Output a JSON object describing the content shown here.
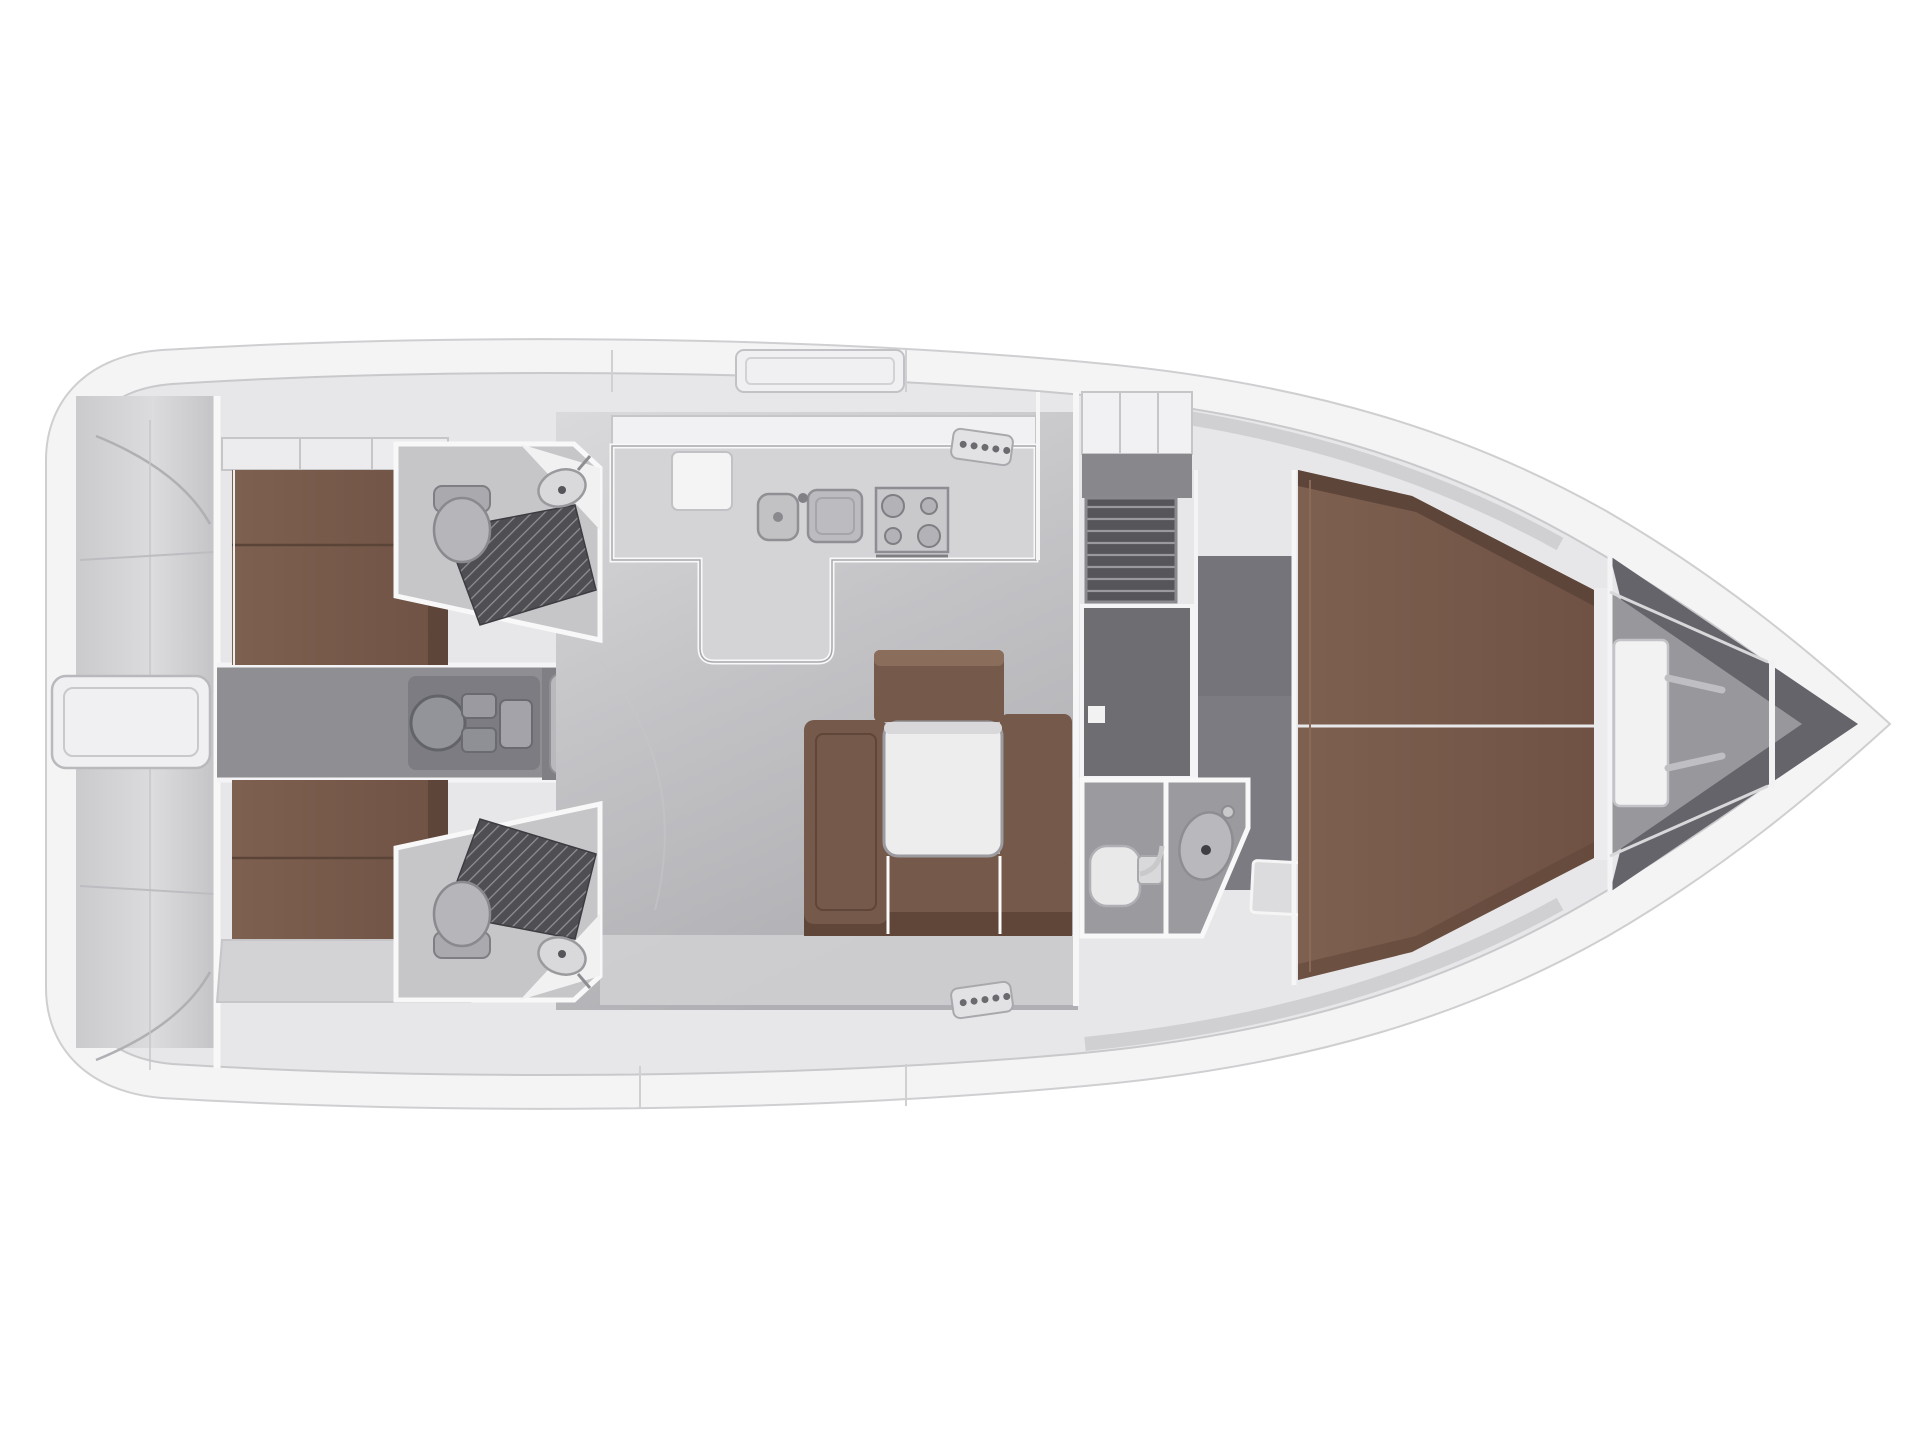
{
  "figure": {
    "kind": "sailing-yacht-interior-floor-plan-top-view",
    "orientation": "bow-right-stern-left"
  },
  "palette": {
    "background": "#ffffff",
    "hull_fill": "#f4f4f5",
    "hull_stroke": "#cfcfd2",
    "deck_fill": "#e7e7e9",
    "deck_line": "#c9c9cc",
    "cabinet_white": "#f1f1f3",
    "wall_white": "#f8f8f9",
    "counter_fill": "#d4d4d7",
    "floor_light": "#d8d8da",
    "floor_mid": "#b9b9bd",
    "corridor_floor": "#8e8e93",
    "head_floor": "#c6c6c9",
    "entry_floor": "#7b7b81",
    "wardrobe_dark": "#6d6d72",
    "louver_dark": "#55555a",
    "midhead_floor": "#9a9a9f",
    "machinery_gray": "#7c7c82",
    "steps_gray": "#b9b9bd",
    "grate_dark": "#4e4e53",
    "bed_brown": "#7a5c4c",
    "bed_brown_dark": "#5e4539",
    "sofa_brown": "#75594a",
    "sofa_brown_dark": "#5f4638",
    "sofa_brown_light": "#8b6d5b",
    "table_fill": "#ededee",
    "fixture_light": "#e9e9ea",
    "fixture_stroke": "#a9a9ad",
    "metal_gray": "#c3c3c7",
    "bow_dark": "#64646a",
    "bow_floor": "#97979c",
    "shelf_light": "#d3d3d6"
  },
  "features": {
    "stern": {
      "lazarette_hatch": 1,
      "transom_panels": 2
    },
    "aft_cabins": {
      "count": 2,
      "beds": 2,
      "mattress_split_lines": 2,
      "locker_bands": 2
    },
    "aft_heads": {
      "count": 2,
      "toilets": 2,
      "shower_grates": 2,
      "sinks": 2
    },
    "companionway": {
      "step_treads": 4,
      "engine_compartment": 1
    },
    "galley": {
      "sink_basins": 2,
      "stove_burners": 4,
      "fridge_lid": 1,
      "l_shaped_counter": 1
    },
    "salon": {
      "table": 1,
      "settee_sections": 4
    },
    "midship": {
      "louver_locker": 1,
      "wardrobe_room": 1,
      "door_handle": 1
    },
    "mid_head": {
      "toilet": 1,
      "sink": 1,
      "entry_steps": 2
    },
    "forward_cabin": {
      "bed": 1,
      "mattress_split_lines": 1
    },
    "bow": {
      "windlass": 1,
      "windlass_handles": 2,
      "bulkhead": 1
    },
    "deck": {
      "sliding_hatch": 1,
      "vent_plates": 2,
      "vent_dots_per_plate": 5
    }
  }
}
